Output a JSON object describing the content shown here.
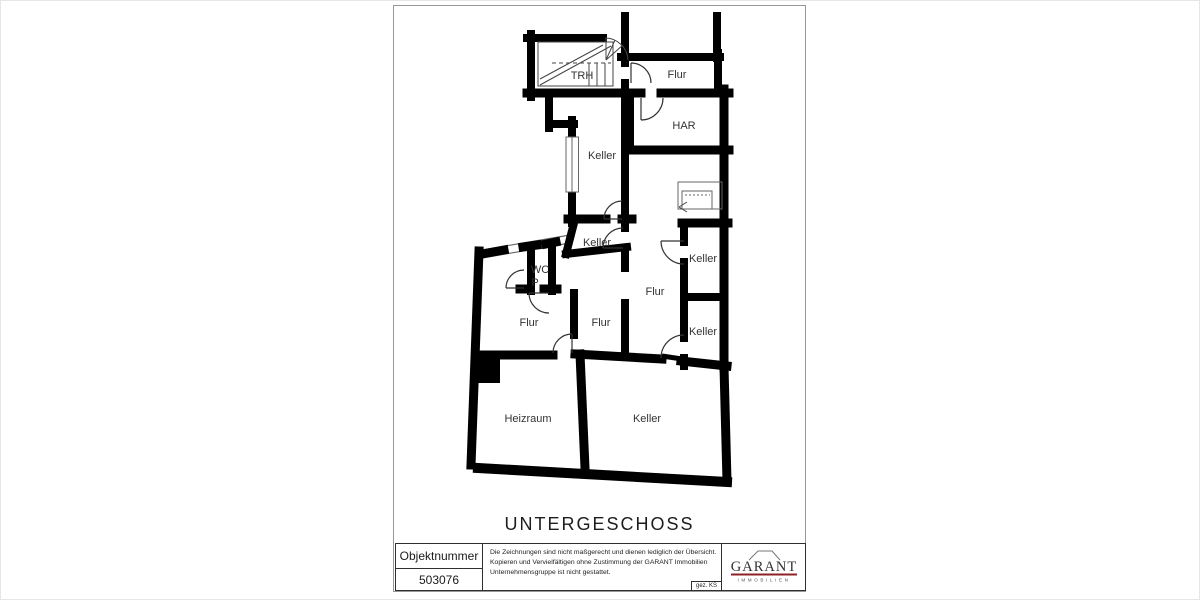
{
  "page": {
    "title": "UNTERGESCHOSS"
  },
  "plan": {
    "rooms": [
      {
        "label": "TRH"
      },
      {
        "label": "Flur"
      },
      {
        "label": "HAR"
      },
      {
        "label": "Keller"
      },
      {
        "label": "Keller"
      },
      {
        "label": "WC"
      },
      {
        "label": "P"
      },
      {
        "label": "Flur"
      },
      {
        "label": "Flur"
      },
      {
        "label": "Flur"
      },
      {
        "label": "Keller"
      },
      {
        "label": "Keller"
      },
      {
        "label": "Heizraum"
      },
      {
        "label": "Keller"
      }
    ],
    "wall_color": "#000000",
    "label_color": "#333333"
  },
  "footer": {
    "object_number_label": "Objektnummer",
    "object_number": "503076",
    "disclaimer_lines": [
      "Die Zeichnungen sind nicht maßgerecht und dienen lediglich der Übersicht.",
      "Kopieren und Vervielfältigen ohne Zustimmung der GARANT Immobilien",
      "Unternehmensgruppe ist nicht gestattet."
    ],
    "signed": "gez. KS",
    "logo": {
      "name": "GARANT",
      "subtitle": "IMMOBILIEN",
      "accent_color": "#8f2026"
    }
  }
}
